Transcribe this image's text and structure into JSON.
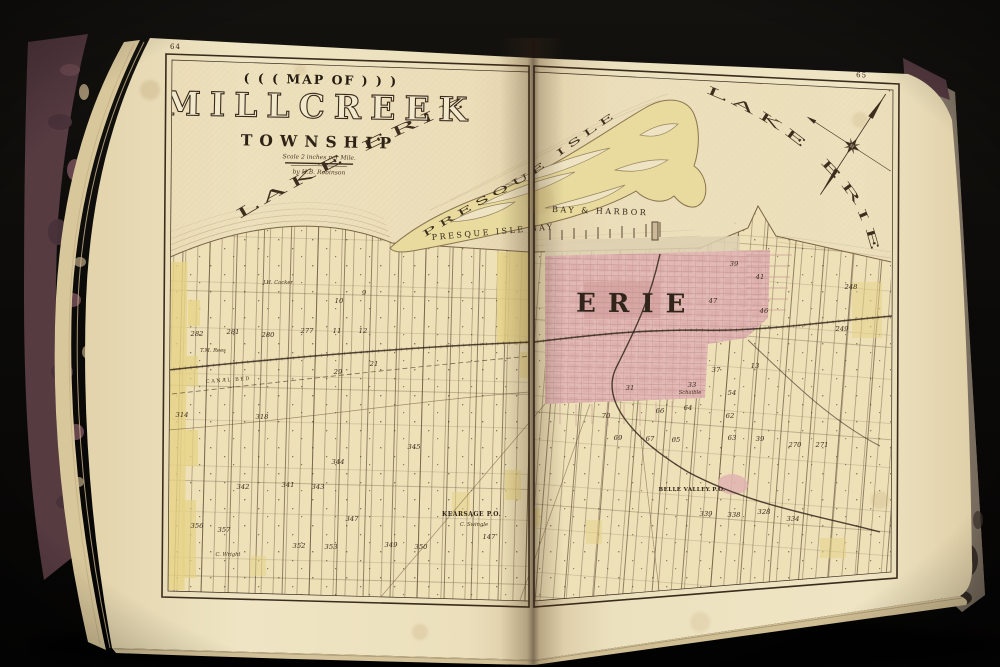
{
  "scene": {
    "background": "#0b0a08",
    "cover_left": "#563b41",
    "cover_right": "#8a7e6f",
    "page": "#efe4c2",
    "page_edge": "#d9c79c",
    "ink": "#3a2b1d",
    "plot_yellow": "#e6d284",
    "city_pink": "#e3b9b6",
    "peninsula_yellow": "#e9db9e",
    "water_tint": "#ebdcb6"
  },
  "pages": {
    "left_number": "64",
    "right_number": "65"
  },
  "title": {
    "kicker": "( ( (  MAP OF  ) ) )",
    "main": "MILLCREEK",
    "sub": "TOWNSHIP",
    "scale_note": "Scale 2 inches per Mile.",
    "byline": "by H.B. Robinson"
  },
  "map": {
    "water_labels": {
      "lake_left": "LAKE ERIE",
      "lake_right": "LAKE ERIE",
      "peninsula": "PRESQUE ISLE",
      "bay": "PRESQUE ISLE BAY",
      "harbor": "BAY & HARBOR"
    },
    "place_labels": {
      "city": "ERIE",
      "kearsage": "KEARSAGE P.O.",
      "belle_valley": "BELLE VALLEY P.O.",
      "canal": "CANAL BED",
      "compass_north": "N"
    },
    "plots": [
      {
        "t": "282",
        "x": 197,
        "y": 336
      },
      {
        "t": "281",
        "x": 233,
        "y": 334
      },
      {
        "t": "280",
        "x": 268,
        "y": 337
      },
      {
        "t": "277",
        "x": 307,
        "y": 333
      },
      {
        "t": "11",
        "x": 337,
        "y": 333
      },
      {
        "t": "12",
        "x": 363,
        "y": 333
      },
      {
        "t": "10",
        "x": 339,
        "y": 303
      },
      {
        "t": "9",
        "x": 364,
        "y": 295
      },
      {
        "t": "29",
        "x": 338,
        "y": 374
      },
      {
        "t": "21",
        "x": 374,
        "y": 366
      },
      {
        "t": "314",
        "x": 182,
        "y": 417
      },
      {
        "t": "318",
        "x": 262,
        "y": 419
      },
      {
        "t": "344",
        "x": 338,
        "y": 464
      },
      {
        "t": "345",
        "x": 414,
        "y": 449
      },
      {
        "t": "341",
        "x": 288,
        "y": 487
      },
      {
        "t": "342",
        "x": 243,
        "y": 489
      },
      {
        "t": "343",
        "x": 318,
        "y": 489
      },
      {
        "t": "347",
        "x": 352,
        "y": 521
      },
      {
        "t": "352",
        "x": 299,
        "y": 548
      },
      {
        "t": "353",
        "x": 331,
        "y": 549
      },
      {
        "t": "349",
        "x": 391,
        "y": 547
      },
      {
        "t": "350",
        "x": 421,
        "y": 549
      },
      {
        "t": "356",
        "x": 197,
        "y": 528
      },
      {
        "t": "357",
        "x": 224,
        "y": 532
      },
      {
        "t": "147",
        "x": 489,
        "y": 539
      },
      {
        "t": "39",
        "x": 734,
        "y": 266
      },
      {
        "t": "41",
        "x": 760,
        "y": 279
      },
      {
        "t": "47",
        "x": 713,
        "y": 303
      },
      {
        "t": "46",
        "x": 764,
        "y": 313
      },
      {
        "t": "37",
        "x": 716,
        "y": 372
      },
      {
        "t": "13",
        "x": 755,
        "y": 368
      },
      {
        "t": "31",
        "x": 630,
        "y": 390
      },
      {
        "t": "33",
        "x": 692,
        "y": 387
      },
      {
        "t": "54",
        "x": 732,
        "y": 395
      },
      {
        "t": "70",
        "x": 606,
        "y": 418
      },
      {
        "t": "66",
        "x": 660,
        "y": 413
      },
      {
        "t": "64",
        "x": 688,
        "y": 410
      },
      {
        "t": "62",
        "x": 730,
        "y": 418
      },
      {
        "t": "69",
        "x": 618,
        "y": 440
      },
      {
        "t": "67",
        "x": 650,
        "y": 441
      },
      {
        "t": "65",
        "x": 676,
        "y": 442
      },
      {
        "t": "63",
        "x": 732,
        "y": 440
      },
      {
        "t": "39",
        "x": 760,
        "y": 441
      },
      {
        "t": "248",
        "x": 851,
        "y": 289
      },
      {
        "t": "249",
        "x": 842,
        "y": 331
      },
      {
        "t": "271",
        "x": 822,
        "y": 447
      },
      {
        "t": "270",
        "x": 795,
        "y": 447
      },
      {
        "t": "339",
        "x": 706,
        "y": 516
      },
      {
        "t": "338",
        "x": 734,
        "y": 517
      },
      {
        "t": "328",
        "x": 764,
        "y": 514
      },
      {
        "t": "334",
        "x": 793,
        "y": 521
      }
    ],
    "names": [
      {
        "t": "J.H. Cocker",
        "x": 278,
        "y": 284
      },
      {
        "t": "T.M. Rees",
        "x": 213,
        "y": 352
      },
      {
        "t": "C. Swingle",
        "x": 474,
        "y": 526
      },
      {
        "t": "C. Wright",
        "x": 228,
        "y": 556
      },
      {
        "t": "Schaible",
        "x": 690,
        "y": 394
      }
    ]
  }
}
